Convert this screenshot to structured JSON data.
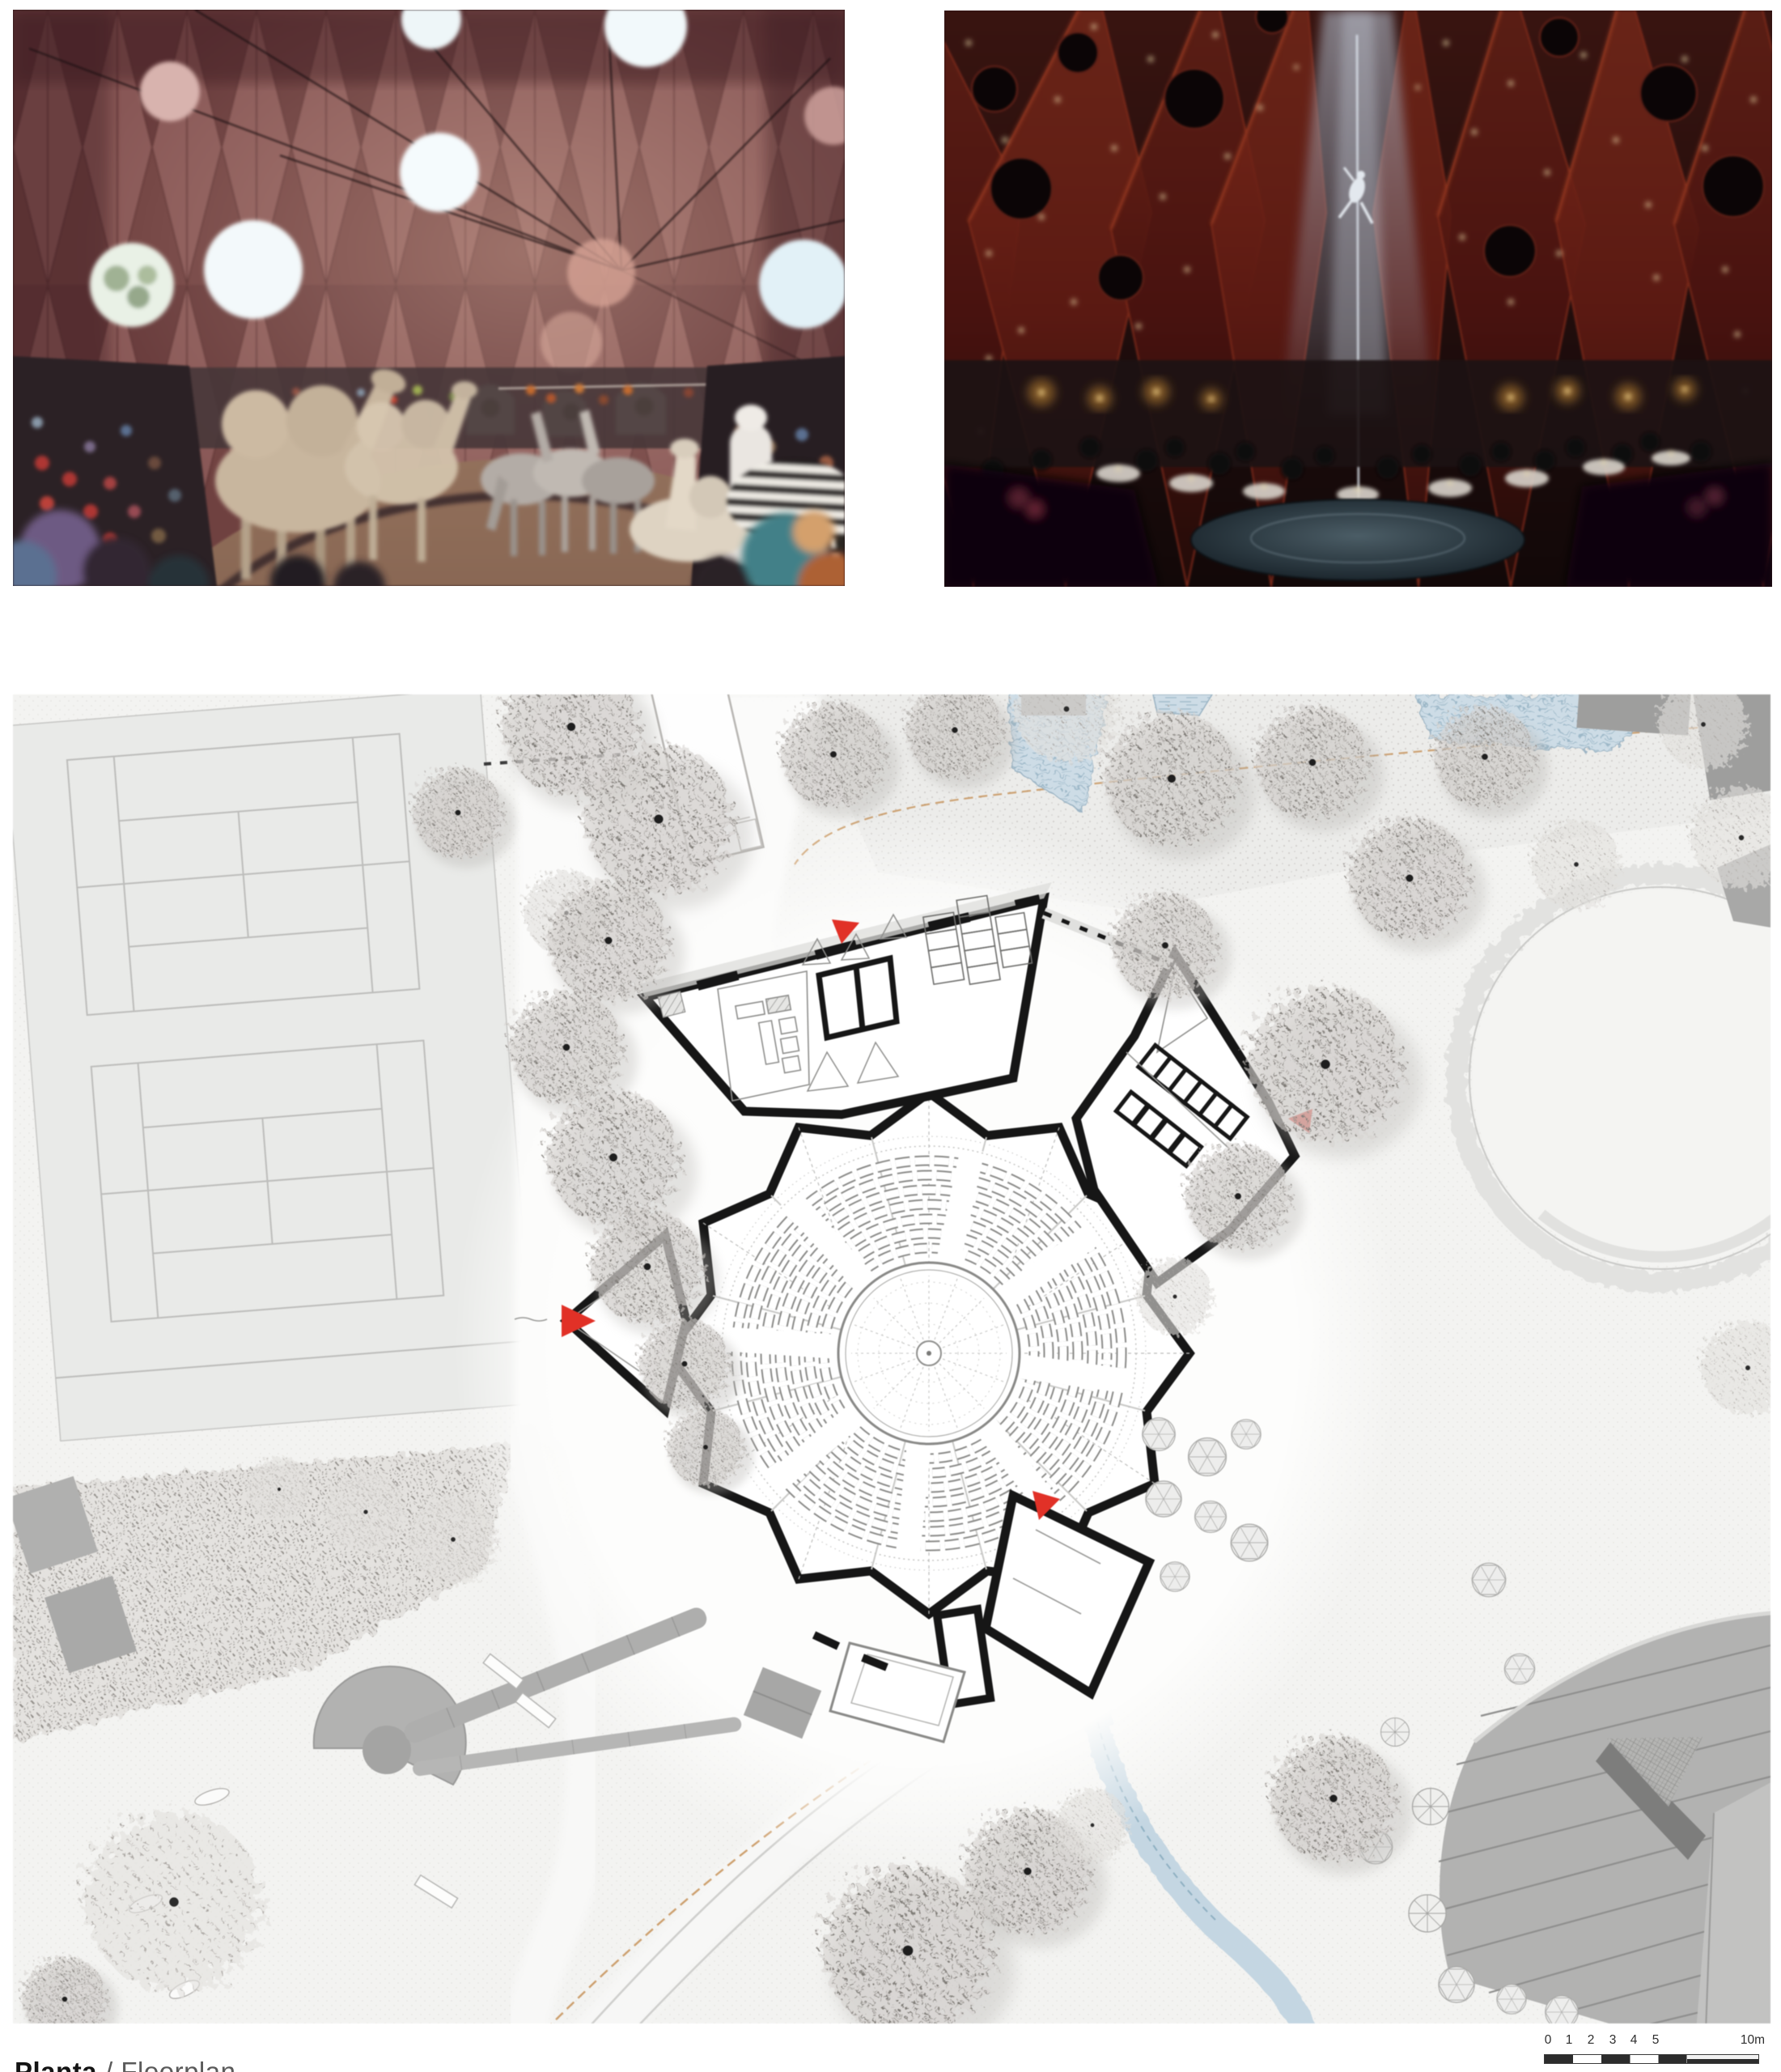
{
  "caption": {
    "primary": "Planta",
    "secondary": "/ Floorplan"
  },
  "scalebar": {
    "ticks": [
      "0",
      "1",
      "2",
      "3",
      "4",
      "5"
    ],
    "end_label": "10m"
  },
  "colors": {
    "accent_red": "#e13127",
    "plan_wall_black": "#161616",
    "water_blue": "#c9d9e3",
    "facade_maroon": "#7b4a48",
    "drape_red": "#6e2418",
    "page_background": "#ffffff"
  }
}
